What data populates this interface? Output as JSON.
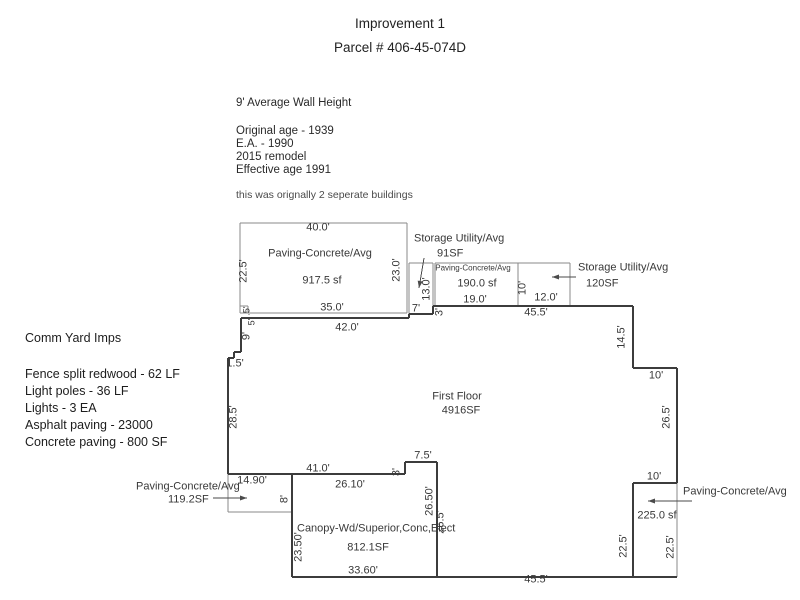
{
  "title": {
    "line1": "Improvement 1",
    "line2": "Parcel # 406-45-074D"
  },
  "building_notes": {
    "wall_height": "9' Average Wall Height",
    "lines": [
      "Original age - 1939",
      "E.A. - 1990",
      "2015 remodel",
      "Effective age 1991"
    ],
    "footnote": "this was orignally 2 seperate buildings"
  },
  "comm_yard": {
    "heading": "Comm Yard Imps",
    "lines": [
      "Fence split redwood - 62 LF",
      "Light poles - 36 LF",
      "Lights - 3 EA",
      "Asphalt paving - 23000",
      "Concrete paving - 800 SF"
    ]
  },
  "colors": {
    "text": "#1f1f1f",
    "diagram_text": "#383838",
    "line_thick": "#3c3c3c",
    "line_thin": "#888888"
  },
  "diagram": {
    "labels": [
      {
        "n": "dim-paving1-top",
        "t": "40.0'",
        "x": 318,
        "y": 228
      },
      {
        "n": "label-paving1-type",
        "t": "Paving-Concrete/Avg",
        "x": 320,
        "y": 254
      },
      {
        "n": "label-paving1-sf",
        "t": "917.5 sf",
        "x": 322,
        "y": 281
      },
      {
        "n": "dim-paving1-left",
        "t": "22.5'",
        "x": 244,
        "y": 271,
        "r": -90
      },
      {
        "n": "dim-paving1-right",
        "t": "23.0'",
        "x": 397,
        "y": 270,
        "r": -90
      },
      {
        "n": "dim-paving1-bottom",
        "t": "35.0'",
        "x": 332,
        "y": 308
      },
      {
        "n": "dim-floor-top-left",
        "t": "42.0'",
        "x": 347,
        "y": 328
      },
      {
        "n": "label-storage91-type",
        "t": "Storage Utility/Avg",
        "x": 414,
        "y": 239,
        "a": "l"
      },
      {
        "n": "label-storage91-sf",
        "t": "91SF",
        "x": 437,
        "y": 254,
        "a": "l"
      },
      {
        "n": "dim-storage91-height",
        "t": "13.0'",
        "x": 427,
        "y": 289,
        "r": -90
      },
      {
        "n": "dim-storage91-width",
        "t": "7'",
        "x": 416,
        "y": 309
      },
      {
        "n": "dim-step-3ft",
        "t": "3'",
        "x": 440,
        "y": 312,
        "r": -90
      },
      {
        "n": "label-paving190-type",
        "t": "Paving-Concrete/Avg",
        "x": 473,
        "y": 268,
        "s": 8
      },
      {
        "n": "label-paving190-sf",
        "t": "190.0 sf",
        "x": 477,
        "y": 284
      },
      {
        "n": "dim-paving190-width",
        "t": "19.0'",
        "x": 475,
        "y": 300
      },
      {
        "n": "dim-storage120-height",
        "t": "10'",
        "x": 523,
        "y": 288,
        "r": -90
      },
      {
        "n": "dim-storage120-width",
        "t": "12.0'",
        "x": 546,
        "y": 298
      },
      {
        "n": "label-storage120-type",
        "t": "Storage Utility/Avg",
        "x": 578,
        "y": 268,
        "a": "l"
      },
      {
        "n": "label-storage120-sf",
        "t": "120SF",
        "x": 586,
        "y": 284,
        "a": "l"
      },
      {
        "n": "dim-floor-top-right",
        "t": "45.5'",
        "x": 536,
        "y": 313
      },
      {
        "n": "dim-floor-right-14-5",
        "t": "14.5'",
        "x": 622,
        "y": 337,
        "r": -90
      },
      {
        "n": "dim-floor-step-10",
        "t": "10'",
        "x": 656,
        "y": 376
      },
      {
        "n": "dim-floor-right-26-5",
        "t": "26.5'",
        "x": 667,
        "y": 417,
        "r": -90
      },
      {
        "n": "dim-floor-step2-10",
        "t": "10'",
        "x": 654,
        "y": 477
      },
      {
        "n": "label-paving225-type",
        "t": "Paving-Concrete/Avg",
        "x": 683,
        "y": 492,
        "a": "l"
      },
      {
        "n": "label-paving225-sf",
        "t": "225.0 sf",
        "x": 657,
        "y": 516
      },
      {
        "n": "dim-floor-right-22-5",
        "t": "22.5'",
        "x": 624,
        "y": 546,
        "r": -90
      },
      {
        "n": "dim-paving225-right",
        "t": "22.5'",
        "x": 671,
        "y": 547,
        "r": -90
      },
      {
        "n": "label-first-floor",
        "t": "First Floor",
        "x": 457,
        "y": 397
      },
      {
        "n": "label-first-floor-sf",
        "t": "4916SF",
        "x": 461,
        "y": 411
      },
      {
        "n": "dim-left-half",
        "t": ".5'",
        "x": 247,
        "y": 311,
        "r": -90,
        "s": 9
      },
      {
        "n": "dim-left-5",
        "t": "5'",
        "x": 252,
        "y": 322,
        "r": -90,
        "s": 9
      },
      {
        "n": "dim-left-9",
        "t": "9'",
        "x": 247,
        "y": 336,
        "r": -90
      },
      {
        "n": "dim-left-1-5",
        "t": "1.5'",
        "x": 235,
        "y": 364
      },
      {
        "n": "dim-left-28-5",
        "t": "28.5'",
        "x": 234,
        "y": 417,
        "r": -90
      },
      {
        "n": "label-paving119-type",
        "t": "Paving-Concrete/Avg",
        "x": 136,
        "y": 487,
        "a": "l"
      },
      {
        "n": "label-paving119-sf",
        "t": "119.2SF",
        "x": 168,
        "y": 500,
        "a": "l"
      },
      {
        "n": "dim-paving119-width",
        "t": "14.90'",
        "x": 252,
        "y": 481
      },
      {
        "n": "dim-paving119-height",
        "t": "8'",
        "x": 285,
        "y": 499,
        "r": -90
      },
      {
        "n": "dim-floor-bottom-41",
        "t": "41.0'",
        "x": 318,
        "y": 469
      },
      {
        "n": "dim-canopy-top",
        "t": "26.10'",
        "x": 350,
        "y": 485
      },
      {
        "n": "dim-canopy-step-3",
        "t": "3'",
        "x": 397,
        "y": 472,
        "r": -90
      },
      {
        "n": "dim-canopy-step-7-5",
        "t": "7.5'",
        "x": 423,
        "y": 456
      },
      {
        "n": "dim-canopy-right",
        "t": "26.50'",
        "x": 430,
        "y": 501,
        "r": -90
      },
      {
        "n": "dim-floor-26-5",
        "t": "26.5'",
        "x": 441,
        "y": 522,
        "r": -90
      },
      {
        "n": "label-canopy-type",
        "t": "Canopy-Wd/Superior,Conc,Elect",
        "x": 297,
        "y": 529,
        "a": "l"
      },
      {
        "n": "label-canopy-sf",
        "t": "812.1SF",
        "x": 368,
        "y": 548
      },
      {
        "n": "dim-canopy-left",
        "t": "23.50'",
        "x": 299,
        "y": 547,
        "r": -90
      },
      {
        "n": "dim-canopy-bottom",
        "t": "33.60'",
        "x": 363,
        "y": 571
      },
      {
        "n": "dim-floor-bottom-45-5",
        "t": "45.5'",
        "x": 536,
        "y": 580
      }
    ],
    "segments_thick": [
      [
        241,
        318,
        409,
        318
      ],
      [
        409,
        318,
        409,
        314
      ],
      [
        409,
        314,
        433,
        314
      ],
      [
        433,
        314,
        433,
        306
      ],
      [
        433,
        306,
        633,
        306
      ],
      [
        633,
        306,
        633,
        368
      ],
      [
        633,
        368,
        677,
        368
      ],
      [
        677,
        368,
        677,
        483
      ],
      [
        677,
        483,
        633,
        483
      ],
      [
        633,
        483,
        633,
        577
      ],
      [
        292,
        577,
        677,
        577
      ],
      [
        292,
        474,
        292,
        577
      ],
      [
        228,
        474,
        405,
        474
      ],
      [
        405,
        474,
        405,
        462
      ],
      [
        405,
        462,
        437,
        462
      ],
      [
        437,
        462,
        437,
        577
      ],
      [
        241,
        318,
        241,
        352
      ],
      [
        241,
        352,
        234,
        352
      ],
      [
        234,
        352,
        234,
        358
      ],
      [
        234,
        358,
        228,
        358
      ],
      [
        228,
        358,
        228,
        474
      ]
    ],
    "segments_thin": [
      [
        240,
        223,
        407,
        223
      ],
      [
        240,
        223,
        240,
        313
      ],
      [
        407,
        223,
        407,
        313
      ],
      [
        240,
        313,
        407,
        313
      ],
      [
        240,
        306,
        248,
        306
      ],
      [
        248,
        306,
        248,
        313
      ],
      [
        409,
        263,
        433,
        263
      ],
      [
        409,
        263,
        409,
        314
      ],
      [
        433,
        263,
        433,
        314
      ],
      [
        435,
        263,
        518,
        263
      ],
      [
        435,
        263,
        435,
        306
      ],
      [
        518,
        263,
        518,
        306
      ],
      [
        435,
        306,
        518,
        306
      ],
      [
        518,
        263,
        570,
        263
      ],
      [
        570,
        263,
        570,
        306
      ],
      [
        518,
        306,
        570,
        306
      ],
      [
        228,
        474,
        228,
        512
      ],
      [
        228,
        512,
        292,
        512
      ],
      [
        292,
        474,
        292,
        512
      ],
      [
        677,
        483,
        677,
        577
      ]
    ],
    "arrows": [
      {
        "n": "arrow-storage91",
        "x1": 424,
        "y1": 258,
        "x2": 419,
        "y2": 288
      },
      {
        "n": "arrow-storage120",
        "x1": 576,
        "y1": 277,
        "x2": 552,
        "y2": 277
      },
      {
        "n": "arrow-paving119",
        "x1": 213,
        "y1": 498,
        "x2": 247,
        "y2": 498
      },
      {
        "n": "arrow-paving225",
        "x1": 692,
        "y1": 501,
        "x2": 648,
        "y2": 501
      }
    ]
  }
}
